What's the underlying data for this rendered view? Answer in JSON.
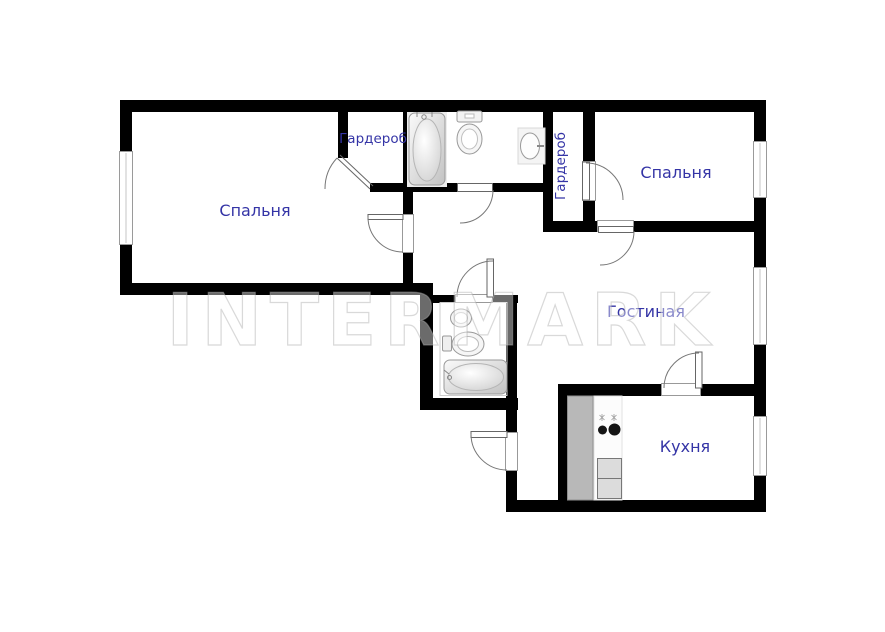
{
  "watermark": "INTERMARK",
  "rooms": {
    "bedroom1": {
      "label": "Спальня"
    },
    "bedroom2": {
      "label": "Спальня"
    },
    "wardrobe1": {
      "label": "Гардероб"
    },
    "wardrobe2": {
      "label": "Гардероб"
    },
    "living_room": {
      "label": "Гостиная"
    },
    "kitchen": {
      "label": "Кухня"
    }
  },
  "colors": {
    "walls": "#000000",
    "room_labels": "#3434a6",
    "watermark": "#e9e9e9",
    "cabinet_gray": "#b8b8b8"
  },
  "icons": {
    "bathtub_main": "bathtub-icon",
    "toilet_main": "toilet-icon",
    "sink_main": "sink-icon",
    "bathtub_second": "bathtub-icon",
    "toilet_second": "toilet-icon",
    "sink_second": "sink-icon",
    "stove": "stove-icon",
    "fridge": "fridge-icon",
    "cabinet": "cabinet-icon"
  }
}
